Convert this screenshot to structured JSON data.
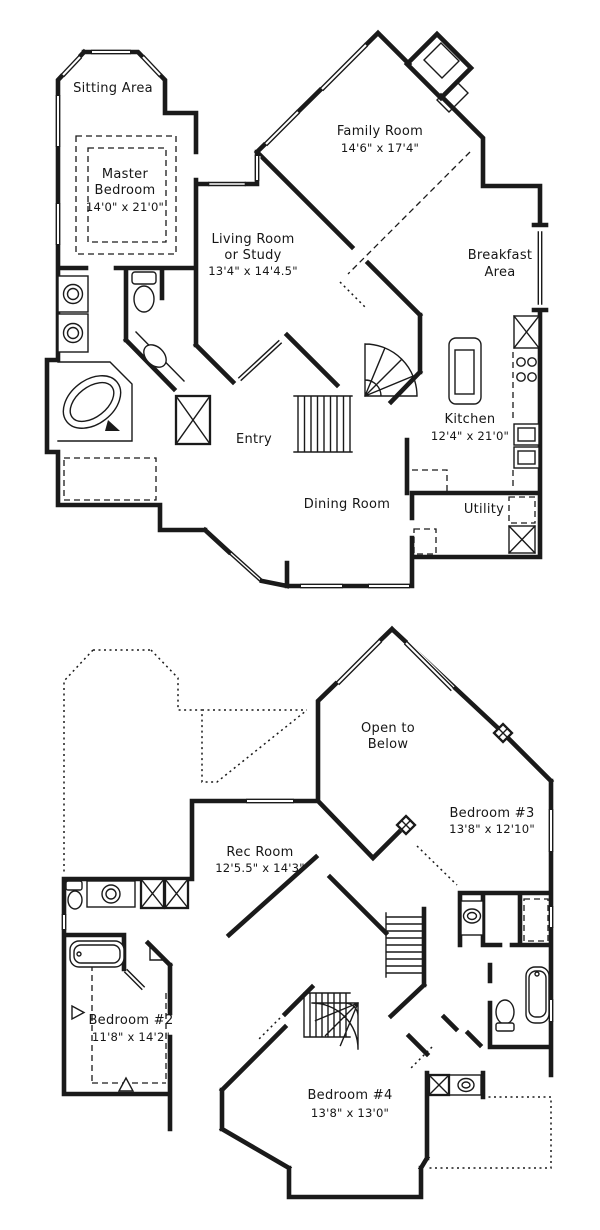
{
  "colors": {
    "ink": "#1a1a1a",
    "paper": "#ffffff"
  },
  "floors": [
    {
      "id": "first-floor",
      "rooms": [
        {
          "id": "sitting-area",
          "lines": [
            "Sitting Area"
          ]
        },
        {
          "id": "master-bedroom",
          "lines": [
            "Master",
            "Bedroom",
            "14'0\" x 21'0\""
          ]
        },
        {
          "id": "family-room",
          "lines": [
            "Family Room",
            "14'6\" x 17'4\""
          ]
        },
        {
          "id": "living-room",
          "lines": [
            "Living Room",
            "or Study",
            "13'4\" x 14'4.5\""
          ]
        },
        {
          "id": "breakfast-area",
          "lines": [
            "Breakfast",
            "Area"
          ]
        },
        {
          "id": "entry",
          "lines": [
            "Entry"
          ]
        },
        {
          "id": "kitchen",
          "lines": [
            "Kitchen",
            "12'4\" x 21'0\""
          ]
        },
        {
          "id": "dining-room",
          "lines": [
            "Dining Room"
          ]
        },
        {
          "id": "utility",
          "lines": [
            "Utility"
          ]
        }
      ]
    },
    {
      "id": "second-floor",
      "rooms": [
        {
          "id": "open-to-below",
          "lines": [
            "Open to",
            "Below"
          ]
        },
        {
          "id": "rec-room",
          "lines": [
            "Rec Room",
            "12'5.5\" x 14'3\""
          ]
        },
        {
          "id": "bedroom-3",
          "lines": [
            "Bedroom #3",
            "13'8\" x 12'10\""
          ]
        },
        {
          "id": "bedroom-2",
          "lines": [
            "Bedroom #2",
            "11'8\" x 14'2\""
          ]
        },
        {
          "id": "bedroom-4",
          "lines": [
            "Bedroom #4",
            "13'8\" x 13'0\""
          ]
        }
      ]
    }
  ]
}
